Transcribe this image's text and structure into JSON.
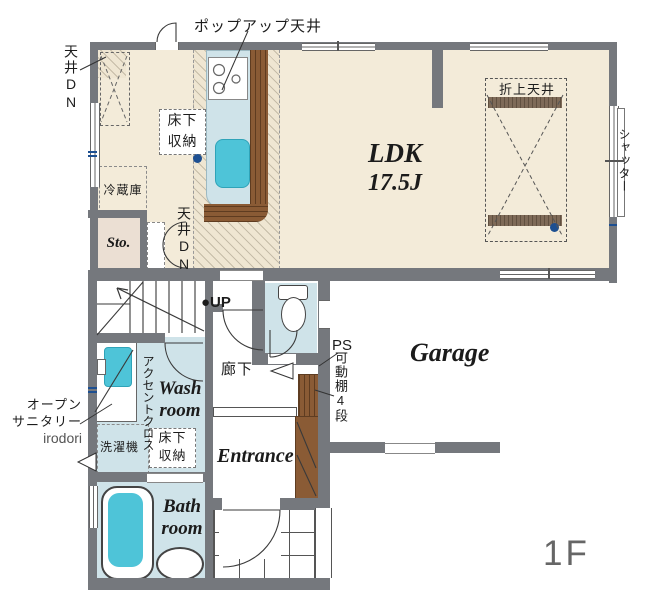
{
  "floor_plan": {
    "floor_label": "1F",
    "rooms": {
      "ldk": {
        "name": "LDK",
        "size": "17.5J"
      },
      "storage": "Sto.",
      "wash_room": {
        "l1": "Wash",
        "l2": "room"
      },
      "bath_room": {
        "l1": "Bath",
        "l2": "room"
      },
      "entrance": "Entrance",
      "garage": "Garage",
      "hallway": "廊下"
    },
    "annotations": {
      "popup_ceiling": "ポップアップ天井",
      "ceiling_down_left": "天井DN",
      "ceiling_down_kitchen": "天井DN",
      "coffered_ceiling": "折上天井",
      "underfloor_storage_kitchen": {
        "l1": "床下",
        "l2": "収納"
      },
      "refrigerator": "冷蔵庫",
      "shutter": "シャッター",
      "stairs_up": "●UP",
      "pipe_space": "PS",
      "accent_cross": "アクセントクロス",
      "open_sanitary": {
        "l1": "オープン",
        "l2": "サニタリー",
        "l3": "irodori"
      },
      "washing_machine": "洗濯機",
      "underfloor_storage_wash": {
        "l1": "床下",
        "l2": "収納"
      },
      "movable_shelf": "可動棚4段"
    },
    "colors": {
      "wall": "#75787d",
      "floor": "#f3ebd9",
      "water_room": "#cfe3e9",
      "fixture_teal": "#4ec4d8",
      "wood": "#8a5b35",
      "storage_room": "#ebdfd3",
      "marker": "#1d4f91",
      "line": "#3a3a3a",
      "floor_label_gray": "#666666"
    }
  }
}
